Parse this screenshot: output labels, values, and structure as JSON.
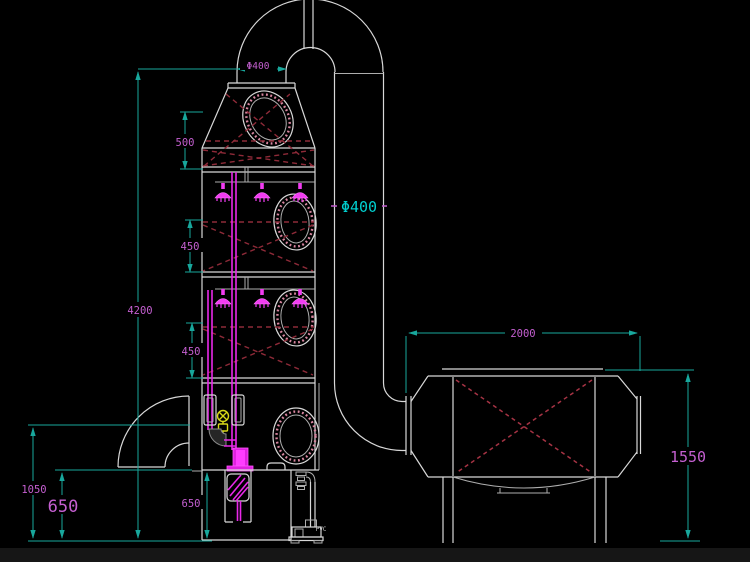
{
  "title": "spray-tower-scrubber-and-carbon-adsorber-cad-drawing",
  "colors": {
    "background": "#000000",
    "outline_white": "#d8d8d8",
    "dimension_line_cyan": "#18a79c",
    "dimension_text_magenta": "#c45fd0",
    "pipe_magenta": "#e828e8",
    "packing_dashed_red": "#8e2a38",
    "adsorber_dashed_red": "#a63344",
    "valve_yellow": "#d8d818",
    "label_cyan": "#00cfcf"
  },
  "dimensions": {
    "stack_outlet_diameter": {
      "label": "Φ400"
    },
    "downpipe_diameter": {
      "label": "Φ400"
    },
    "hopper_height": {
      "label": "500"
    },
    "packing_stage_1_height": {
      "label": "450"
    },
    "packing_stage_2_height": {
      "label": "450"
    },
    "tower_total_height": {
      "label": "4200"
    },
    "inlet_centerline_height": {
      "label": "1050"
    },
    "sump_height_left": {
      "label": "650"
    },
    "sump_height_tower": {
      "label": "650"
    },
    "adsorber_length": {
      "label": "2000"
    },
    "adsorber_height": {
      "label": "1550"
    }
  },
  "annotations": {
    "pump_material": "PVC"
  }
}
